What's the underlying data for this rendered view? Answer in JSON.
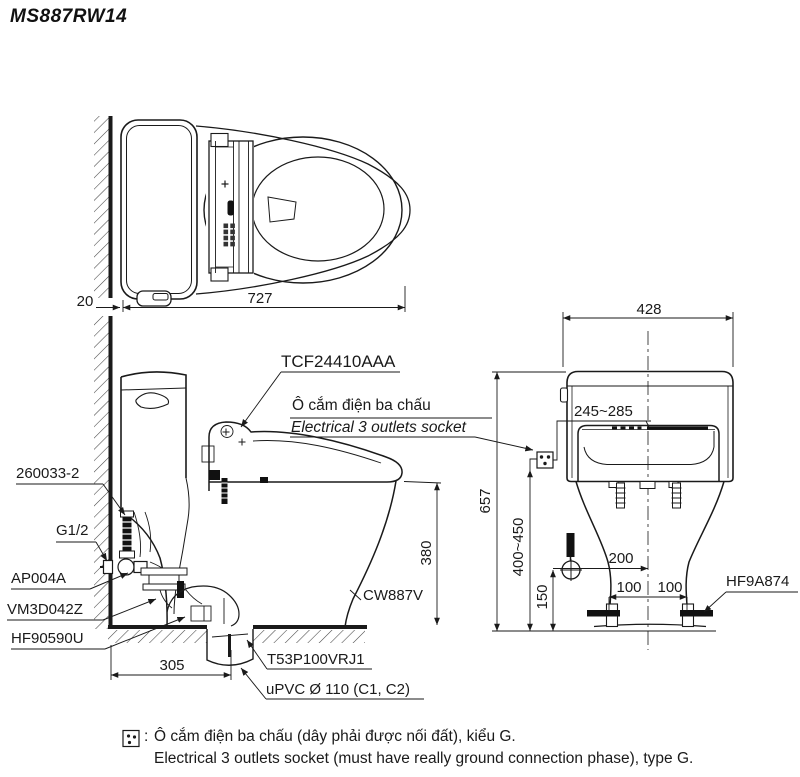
{
  "title": "MS887RW14",
  "colors": {
    "line": "#1a1a1a",
    "text": "#1a1a1a",
    "fill_dark": "#111111"
  },
  "labels": {
    "tcf": "TCF24410AAA",
    "socket_vi": "Ô cắm điện ba chấu",
    "socket_en": "Electrical 3 outlets socket",
    "p260033": "260033-2",
    "g12": "G1/2",
    "ap004a": "AP004A",
    "vm3d042z": "VM3D042Z",
    "hf90590u": "HF90590U",
    "cw887v": "CW887V",
    "t53": "T53P100VRJ1",
    "upvc": "uPVC Ø 110 (C1, C2)",
    "hf9a874": "HF9A874"
  },
  "dims": {
    "top_gap": "20",
    "top_length": "727",
    "seat_height": "380",
    "trap_set": "305",
    "width": "428",
    "socket_range": "245~285",
    "total_height": "657",
    "socket_height": "400~450",
    "supply_height": "150",
    "supply_offset": "200",
    "bolt_left": "100",
    "bolt_right": "100"
  },
  "note": {
    "colon": ":",
    "vi": "Ô cắm điện ba chấu (dây phải được nối đất), kiểu G.",
    "en": "Electrical 3 outlets socket (must have really ground connection phase), type G."
  }
}
